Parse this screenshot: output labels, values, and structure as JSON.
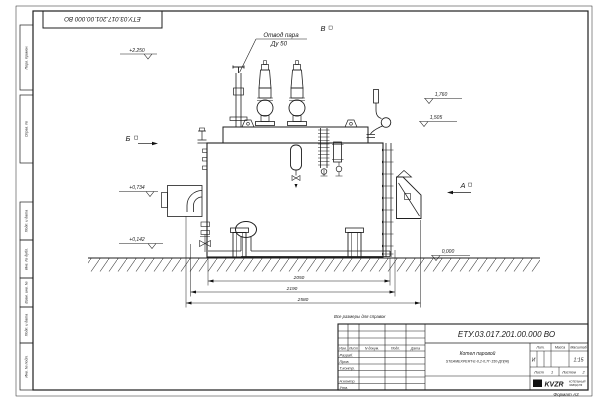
{
  "sheet": {
    "stamp_designation": "ЕТУ.03.017.201.00.000  ВО",
    "reference_note": "Все размеры для справок",
    "format_note": "Формат А3"
  },
  "margin_fields": {
    "perv_primen": "Перв. примен.",
    "sprav_no": "Справ. №",
    "podp_data_1": "Подп. и дата",
    "inv_dubl": "Инв. № дубл.",
    "vzam_inv": "Взам. инв. №",
    "podp_data_2": "Подп. и дата",
    "inv_podl": "Инв. № подл."
  },
  "drawing": {
    "callout_line1": "Отвод пара",
    "callout_line2": "Ду 50",
    "view_a": "А",
    "view_b": "Б",
    "view_v": "В",
    "elevations": {
      "e2250": "+2.250",
      "e1760": "1,760",
      "e1505": "1,505",
      "e0734": "+0,734",
      "e0142": "+0,142",
      "e0000": "0,000"
    },
    "dimensions": {
      "d1": "2050",
      "d2": "2190",
      "d3": "2580"
    }
  },
  "title_block": {
    "designation": "ЕТУ.03.017.201.00.000  ВО",
    "doc_name_line1": "Котел паровой",
    "doc_name_line2": "STEAMEXPERT-Е-0,2-0,7Г-150-ДП(Ж)",
    "lit_header": "Лит.",
    "mass_header": "Масса",
    "scale_header": "Масштаб",
    "lit_value": "И",
    "scale_value": "1:15",
    "sheet_label": "Лист",
    "sheet_value": "1",
    "sheets_label": "Листов",
    "sheets_value": "2",
    "header_izm": "Изм.",
    "header_list": "Лист",
    "header_docnum": "N докум.",
    "header_podp": "Подп.",
    "header_data": "Дата",
    "row_razrab": "Разраб.",
    "row_prov": "Пров.",
    "row_tkontr": "Т.контр.",
    "row_nkontr": "Н.контр.",
    "row_utv": "Утв.",
    "logo_text": "KVZR",
    "logo_sub1": "КОТЕЛЬНЫЙ",
    "logo_sub2": "ЗАВОД РФ"
  }
}
